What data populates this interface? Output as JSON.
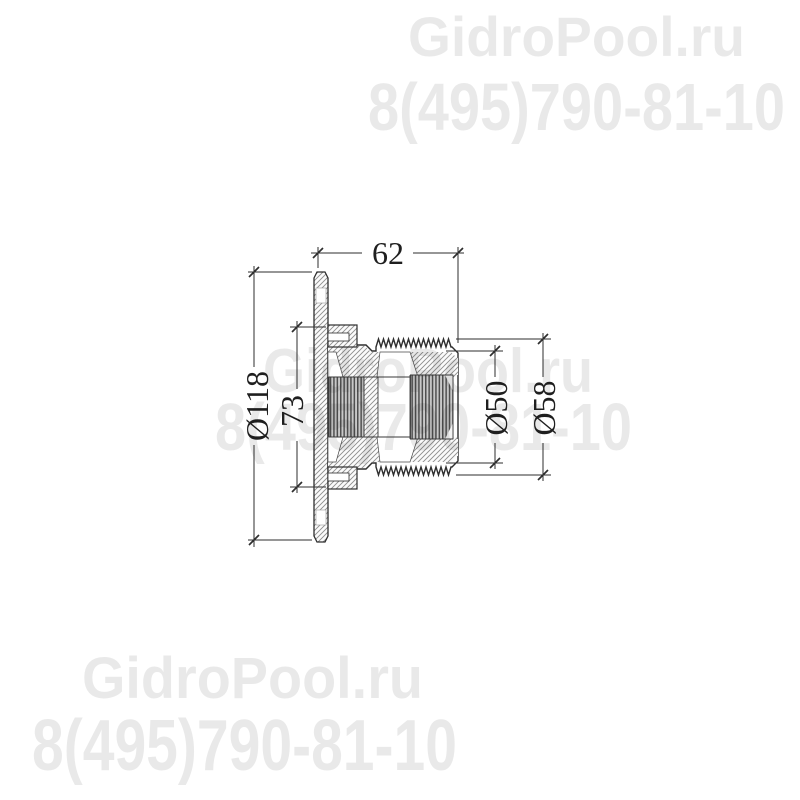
{
  "page": {
    "background": "#ffffff",
    "width": 800,
    "height": 800
  },
  "watermark": {
    "site": "GidroPool.ru",
    "phone": "8(495)790-81-10",
    "color": "#1a1a1a",
    "opacity": 0.095
  },
  "drawing": {
    "line_color": "#2e2e2e",
    "hatch_color": "#8d8d8d",
    "dims": {
      "length": "62",
      "flange_diameter": "Ø118",
      "collar_diameter": "73",
      "thread_inner_diameter": "Ø50",
      "thread_outer_diameter": "Ø58"
    }
  }
}
